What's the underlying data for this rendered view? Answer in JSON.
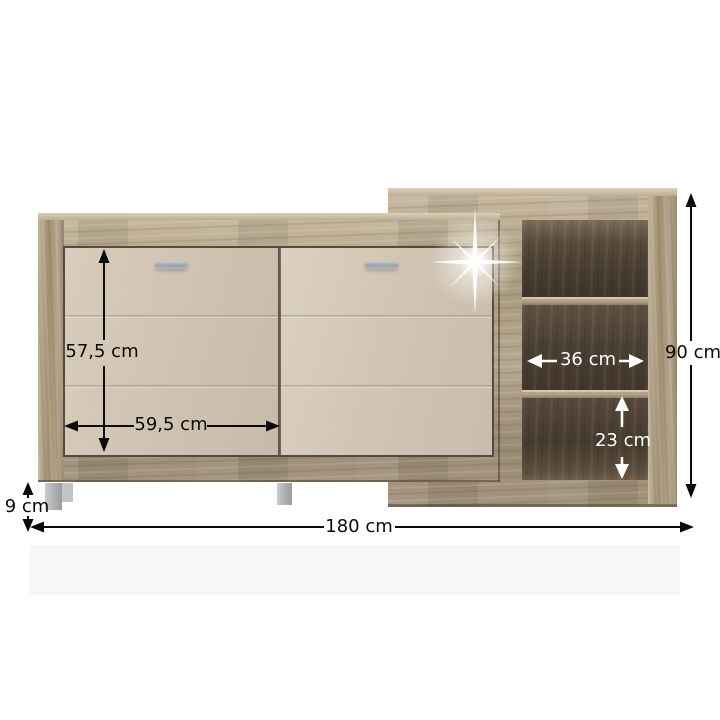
{
  "product": {
    "dimensions": {
      "door_height": "57,5 cm",
      "door_width": "59,5 cm",
      "niche_width": "36 cm",
      "niche_height": "23 cm",
      "total_height": "90 cm",
      "total_width": "180 cm",
      "leg_height": "9 cm"
    },
    "colors": {
      "wood_light": "#c6b79f",
      "wood_mid": "#a79878",
      "wood_dark": "#8a7a64",
      "door_front": "#d1c4b2",
      "niche_interior": "#4a3f33",
      "handle_metal": "#a9aeb6",
      "leg_gray": "#b5b6b8",
      "annotation_black": "#0a0a0a",
      "annotation_white": "#ffffff",
      "background": "#ffffff"
    },
    "icons": {
      "sparkle": "✦"
    }
  }
}
